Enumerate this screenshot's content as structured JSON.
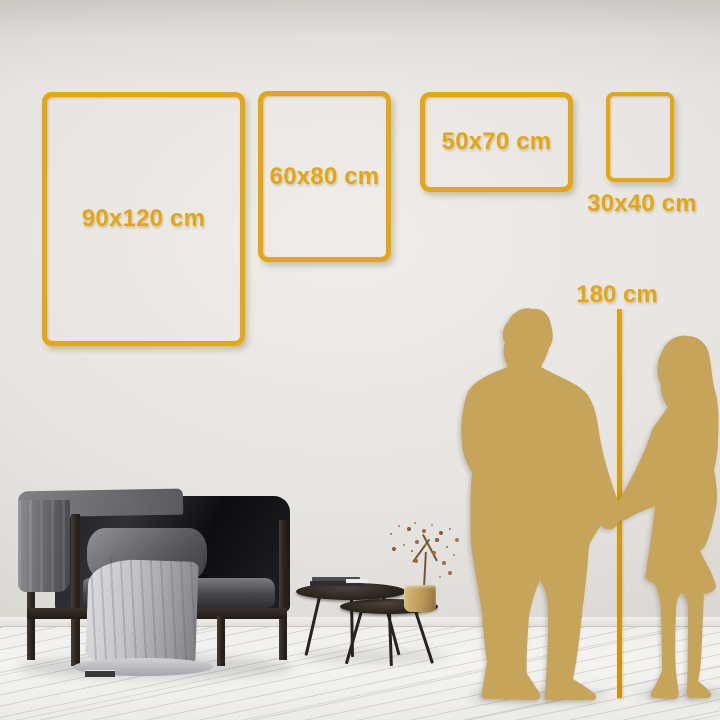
{
  "page": {
    "type": "poster-size-comparison-guide"
  },
  "colors": {
    "accent_gold": "#E4A713",
    "silhouette_gold": "#C6A55A",
    "ruler_gold": "#D0960F",
    "wall_gray": "#DEDBD7",
    "floor_white": "#F3F2F0"
  },
  "frames": [
    {
      "id": "90x120",
      "label": "90x120 cm"
    },
    {
      "id": "60x80",
      "label": "60x80 cm"
    },
    {
      "id": "50x70",
      "label": "50x70 cm"
    },
    {
      "id": "30x40",
      "label": "30x40 cm"
    }
  ],
  "height_reference": {
    "label": "180 cm"
  }
}
